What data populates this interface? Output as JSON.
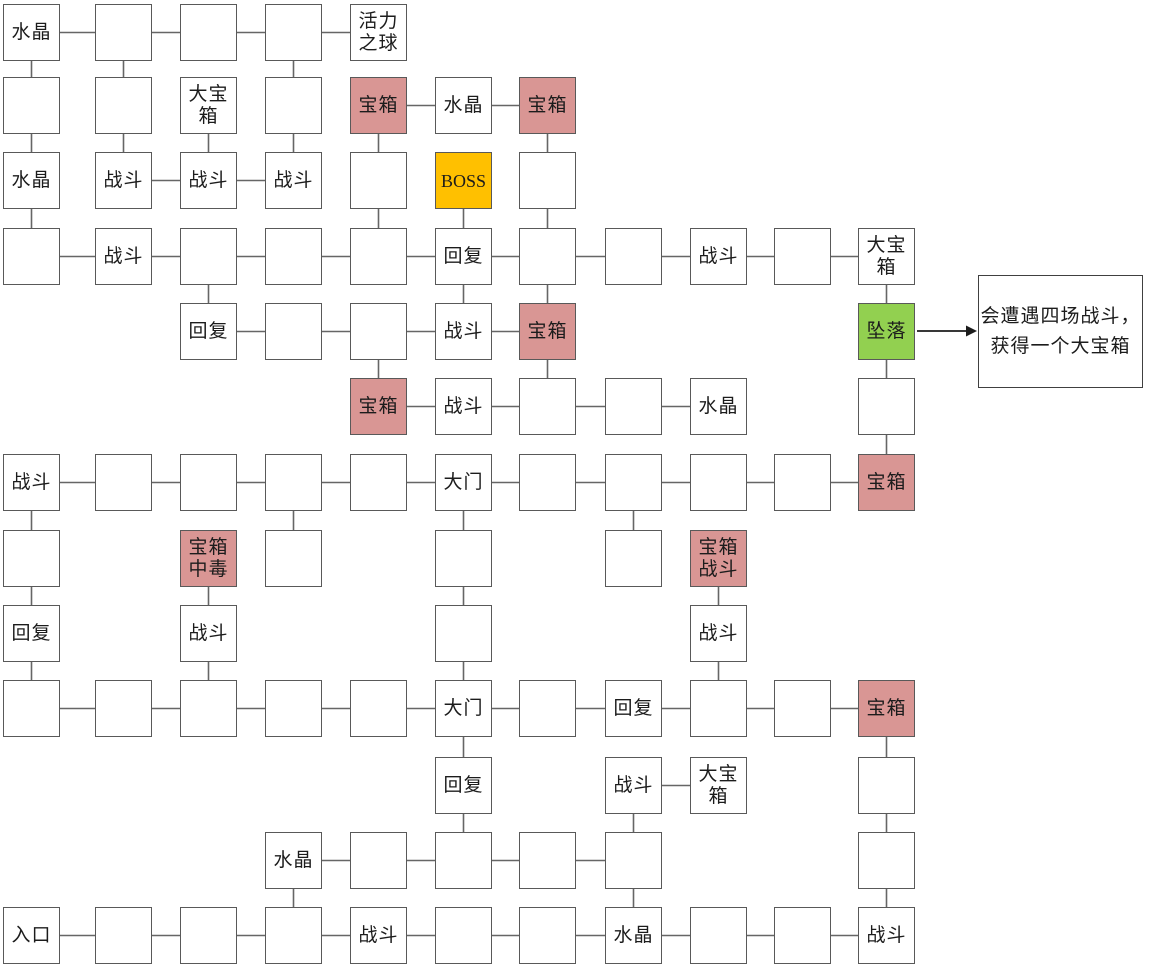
{
  "map": {
    "grid": {
      "col_x": [
        3,
        95,
        180,
        265,
        350,
        435,
        519,
        605,
        690,
        774,
        858
      ],
      "row_y": [
        4,
        77,
        152,
        228,
        303,
        378,
        454,
        530,
        605,
        680,
        757,
        832,
        907
      ],
      "box_w": 57,
      "box_h": 57
    },
    "colors": {
      "room_fill": "#ffffff",
      "chest_fill": "#d99694",
      "boss_fill": "#ffc000",
      "fall_fill": "#92d050",
      "border": "#595959",
      "connector": "#666666",
      "arrow": "#1c1c1c",
      "text": "#1c1c1c"
    },
    "nodes": [
      {
        "id": "r0c0",
        "row": 0,
        "col": 0,
        "type": "normal",
        "label": "水晶"
      },
      {
        "id": "r0c1",
        "row": 0,
        "col": 1,
        "type": "normal",
        "label": ""
      },
      {
        "id": "r0c2",
        "row": 0,
        "col": 2,
        "type": "normal",
        "label": ""
      },
      {
        "id": "r0c3",
        "row": 0,
        "col": 3,
        "type": "normal",
        "label": ""
      },
      {
        "id": "r0c4",
        "row": 0,
        "col": 4,
        "type": "normal",
        "label": "活力\n之球"
      },
      {
        "id": "r1c0",
        "row": 1,
        "col": 0,
        "type": "normal",
        "label": ""
      },
      {
        "id": "r1c1",
        "row": 1,
        "col": 1,
        "type": "normal",
        "label": ""
      },
      {
        "id": "r1c2",
        "row": 1,
        "col": 2,
        "type": "normal",
        "label": "大宝\n箱"
      },
      {
        "id": "r1c3",
        "row": 1,
        "col": 3,
        "type": "normal",
        "label": ""
      },
      {
        "id": "r1c4",
        "row": 1,
        "col": 4,
        "type": "chest",
        "label": "宝箱"
      },
      {
        "id": "r1c5",
        "row": 1,
        "col": 5,
        "type": "normal",
        "label": "水晶"
      },
      {
        "id": "r1c6",
        "row": 1,
        "col": 6,
        "type": "chest",
        "label": "宝箱"
      },
      {
        "id": "r2c0",
        "row": 2,
        "col": 0,
        "type": "normal",
        "label": "水晶"
      },
      {
        "id": "r2c1",
        "row": 2,
        "col": 1,
        "type": "normal",
        "label": "战斗"
      },
      {
        "id": "r2c2",
        "row": 2,
        "col": 2,
        "type": "normal",
        "label": "战斗"
      },
      {
        "id": "r2c3",
        "row": 2,
        "col": 3,
        "type": "normal",
        "label": "战斗"
      },
      {
        "id": "r2c4",
        "row": 2,
        "col": 4,
        "type": "normal",
        "label": ""
      },
      {
        "id": "r2c5",
        "row": 2,
        "col": 5,
        "type": "boss",
        "label": "BOSS"
      },
      {
        "id": "r2c6",
        "row": 2,
        "col": 6,
        "type": "normal",
        "label": ""
      },
      {
        "id": "r3c0",
        "row": 3,
        "col": 0,
        "type": "normal",
        "label": ""
      },
      {
        "id": "r3c1",
        "row": 3,
        "col": 1,
        "type": "normal",
        "label": "战斗"
      },
      {
        "id": "r3c2",
        "row": 3,
        "col": 2,
        "type": "normal",
        "label": ""
      },
      {
        "id": "r3c3",
        "row": 3,
        "col": 3,
        "type": "normal",
        "label": ""
      },
      {
        "id": "r3c4",
        "row": 3,
        "col": 4,
        "type": "normal",
        "label": ""
      },
      {
        "id": "r3c5",
        "row": 3,
        "col": 5,
        "type": "normal",
        "label": "回复"
      },
      {
        "id": "r3c6",
        "row": 3,
        "col": 6,
        "type": "normal",
        "label": ""
      },
      {
        "id": "r3c7",
        "row": 3,
        "col": 7,
        "type": "normal",
        "label": ""
      },
      {
        "id": "r3c8",
        "row": 3,
        "col": 8,
        "type": "normal",
        "label": "战斗"
      },
      {
        "id": "r3c9",
        "row": 3,
        "col": 9,
        "type": "normal",
        "label": ""
      },
      {
        "id": "r3c10",
        "row": 3,
        "col": 10,
        "type": "normal",
        "label": "大宝\n箱"
      },
      {
        "id": "r4c2",
        "row": 4,
        "col": 2,
        "type": "normal",
        "label": "回复"
      },
      {
        "id": "r4c3",
        "row": 4,
        "col": 3,
        "type": "normal",
        "label": ""
      },
      {
        "id": "r4c4",
        "row": 4,
        "col": 4,
        "type": "normal",
        "label": ""
      },
      {
        "id": "r4c5",
        "row": 4,
        "col": 5,
        "type": "normal",
        "label": "战斗"
      },
      {
        "id": "r4c6",
        "row": 4,
        "col": 6,
        "type": "chest",
        "label": "宝箱"
      },
      {
        "id": "r4c10",
        "row": 4,
        "col": 10,
        "type": "fall",
        "label": "坠落"
      },
      {
        "id": "r5c4",
        "row": 5,
        "col": 4,
        "type": "chest",
        "label": "宝箱"
      },
      {
        "id": "r5c5",
        "row": 5,
        "col": 5,
        "type": "normal",
        "label": "战斗"
      },
      {
        "id": "r5c6",
        "row": 5,
        "col": 6,
        "type": "normal",
        "label": ""
      },
      {
        "id": "r5c7",
        "row": 5,
        "col": 7,
        "type": "normal",
        "label": ""
      },
      {
        "id": "r5c8",
        "row": 5,
        "col": 8,
        "type": "normal",
        "label": "水晶"
      },
      {
        "id": "r5c10",
        "row": 5,
        "col": 10,
        "type": "normal",
        "label": ""
      },
      {
        "id": "r6c0",
        "row": 6,
        "col": 0,
        "type": "normal",
        "label": "战斗"
      },
      {
        "id": "r6c1",
        "row": 6,
        "col": 1,
        "type": "normal",
        "label": ""
      },
      {
        "id": "r6c2",
        "row": 6,
        "col": 2,
        "type": "normal",
        "label": ""
      },
      {
        "id": "r6c3",
        "row": 6,
        "col": 3,
        "type": "normal",
        "label": ""
      },
      {
        "id": "r6c4",
        "row": 6,
        "col": 4,
        "type": "normal",
        "label": ""
      },
      {
        "id": "r6c5",
        "row": 6,
        "col": 5,
        "type": "normal",
        "label": "大门"
      },
      {
        "id": "r6c6",
        "row": 6,
        "col": 6,
        "type": "normal",
        "label": ""
      },
      {
        "id": "r6c7",
        "row": 6,
        "col": 7,
        "type": "normal",
        "label": ""
      },
      {
        "id": "r6c8",
        "row": 6,
        "col": 8,
        "type": "normal",
        "label": ""
      },
      {
        "id": "r6c9",
        "row": 6,
        "col": 9,
        "type": "normal",
        "label": ""
      },
      {
        "id": "r6c10",
        "row": 6,
        "col": 10,
        "type": "chest",
        "label": "宝箱"
      },
      {
        "id": "r7c0",
        "row": 7,
        "col": 0,
        "type": "normal",
        "label": ""
      },
      {
        "id": "r7c2",
        "row": 7,
        "col": 2,
        "type": "chest",
        "label": "宝箱\n中毒"
      },
      {
        "id": "r7c3",
        "row": 7,
        "col": 3,
        "type": "normal",
        "label": ""
      },
      {
        "id": "r7c5",
        "row": 7,
        "col": 5,
        "type": "normal",
        "label": ""
      },
      {
        "id": "r7c7",
        "row": 7,
        "col": 7,
        "type": "normal",
        "label": ""
      },
      {
        "id": "r7c8",
        "row": 7,
        "col": 8,
        "type": "chest",
        "label": "宝箱\n战斗"
      },
      {
        "id": "r8c0",
        "row": 8,
        "col": 0,
        "type": "normal",
        "label": "回复"
      },
      {
        "id": "r8c2",
        "row": 8,
        "col": 2,
        "type": "normal",
        "label": "战斗"
      },
      {
        "id": "r8c5",
        "row": 8,
        "col": 5,
        "type": "normal",
        "label": ""
      },
      {
        "id": "r8c8",
        "row": 8,
        "col": 8,
        "type": "normal",
        "label": "战斗"
      },
      {
        "id": "r9c0",
        "row": 9,
        "col": 0,
        "type": "normal",
        "label": ""
      },
      {
        "id": "r9c1",
        "row": 9,
        "col": 1,
        "type": "normal",
        "label": ""
      },
      {
        "id": "r9c2",
        "row": 9,
        "col": 2,
        "type": "normal",
        "label": ""
      },
      {
        "id": "r9c3",
        "row": 9,
        "col": 3,
        "type": "normal",
        "label": ""
      },
      {
        "id": "r9c4",
        "row": 9,
        "col": 4,
        "type": "normal",
        "label": ""
      },
      {
        "id": "r9c5",
        "row": 9,
        "col": 5,
        "type": "normal",
        "label": "大门"
      },
      {
        "id": "r9c6",
        "row": 9,
        "col": 6,
        "type": "normal",
        "label": ""
      },
      {
        "id": "r9c7",
        "row": 9,
        "col": 7,
        "type": "normal",
        "label": "回复"
      },
      {
        "id": "r9c8",
        "row": 9,
        "col": 8,
        "type": "normal",
        "label": ""
      },
      {
        "id": "r9c9",
        "row": 9,
        "col": 9,
        "type": "normal",
        "label": ""
      },
      {
        "id": "r9c10",
        "row": 9,
        "col": 10,
        "type": "chest",
        "label": "宝箱"
      },
      {
        "id": "r10c5",
        "row": 10,
        "col": 5,
        "type": "normal",
        "label": "回复"
      },
      {
        "id": "r10c7",
        "row": 10,
        "col": 7,
        "type": "normal",
        "label": "战斗"
      },
      {
        "id": "r10c8",
        "row": 10,
        "col": 8,
        "type": "normal",
        "label": "大宝\n箱"
      },
      {
        "id": "r10c10",
        "row": 10,
        "col": 10,
        "type": "normal",
        "label": ""
      },
      {
        "id": "r11c3",
        "row": 11,
        "col": 3,
        "type": "normal",
        "label": "水晶"
      },
      {
        "id": "r11c4",
        "row": 11,
        "col": 4,
        "type": "normal",
        "label": ""
      },
      {
        "id": "r11c5",
        "row": 11,
        "col": 5,
        "type": "normal",
        "label": ""
      },
      {
        "id": "r11c6",
        "row": 11,
        "col": 6,
        "type": "normal",
        "label": ""
      },
      {
        "id": "r11c7",
        "row": 11,
        "col": 7,
        "type": "normal",
        "label": ""
      },
      {
        "id": "r11c10",
        "row": 11,
        "col": 10,
        "type": "normal",
        "label": ""
      },
      {
        "id": "r12c0",
        "row": 12,
        "col": 0,
        "type": "normal",
        "label": "入口"
      },
      {
        "id": "r12c1",
        "row": 12,
        "col": 1,
        "type": "normal",
        "label": ""
      },
      {
        "id": "r12c2",
        "row": 12,
        "col": 2,
        "type": "normal",
        "label": ""
      },
      {
        "id": "r12c3",
        "row": 12,
        "col": 3,
        "type": "normal",
        "label": ""
      },
      {
        "id": "r12c4",
        "row": 12,
        "col": 4,
        "type": "normal",
        "label": "战斗"
      },
      {
        "id": "r12c5",
        "row": 12,
        "col": 5,
        "type": "normal",
        "label": ""
      },
      {
        "id": "r12c6",
        "row": 12,
        "col": 6,
        "type": "normal",
        "label": ""
      },
      {
        "id": "r12c7",
        "row": 12,
        "col": 7,
        "type": "normal",
        "label": "水晶"
      },
      {
        "id": "r12c8",
        "row": 12,
        "col": 8,
        "type": "normal",
        "label": ""
      },
      {
        "id": "r12c9",
        "row": 12,
        "col": 9,
        "type": "normal",
        "label": ""
      },
      {
        "id": "r12c10",
        "row": 12,
        "col": 10,
        "type": "normal",
        "label": "战斗"
      }
    ],
    "edges": [
      [
        "r0c0",
        "r0c1"
      ],
      [
        "r0c1",
        "r0c2"
      ],
      [
        "r0c2",
        "r0c3"
      ],
      [
        "r0c3",
        "r0c4"
      ],
      [
        "r1c4",
        "r1c5"
      ],
      [
        "r1c5",
        "r1c6"
      ],
      [
        "r2c1",
        "r2c2"
      ],
      [
        "r2c2",
        "r2c3"
      ],
      [
        "r3c0",
        "r3c1"
      ],
      [
        "r3c1",
        "r3c2"
      ],
      [
        "r3c2",
        "r3c3"
      ],
      [
        "r3c3",
        "r3c4"
      ],
      [
        "r3c4",
        "r3c5"
      ],
      [
        "r3c5",
        "r3c6"
      ],
      [
        "r3c6",
        "r3c7"
      ],
      [
        "r3c7",
        "r3c8"
      ],
      [
        "r3c8",
        "r3c9"
      ],
      [
        "r3c9",
        "r3c10"
      ],
      [
        "r4c2",
        "r4c3"
      ],
      [
        "r4c3",
        "r4c4"
      ],
      [
        "r4c4",
        "r4c5"
      ],
      [
        "r4c5",
        "r4c6"
      ],
      [
        "r5c4",
        "r5c5"
      ],
      [
        "r5c5",
        "r5c6"
      ],
      [
        "r5c6",
        "r5c7"
      ],
      [
        "r5c7",
        "r5c8"
      ],
      [
        "r6c0",
        "r6c1"
      ],
      [
        "r6c1",
        "r6c2"
      ],
      [
        "r6c2",
        "r6c3"
      ],
      [
        "r6c3",
        "r6c4"
      ],
      [
        "r6c4",
        "r6c5"
      ],
      [
        "r6c5",
        "r6c6"
      ],
      [
        "r6c6",
        "r6c7"
      ],
      [
        "r6c7",
        "r6c8"
      ],
      [
        "r6c8",
        "r6c9"
      ],
      [
        "r6c9",
        "r6c10"
      ],
      [
        "r9c0",
        "r9c1"
      ],
      [
        "r9c1",
        "r9c2"
      ],
      [
        "r9c2",
        "r9c3"
      ],
      [
        "r9c3",
        "r9c4"
      ],
      [
        "r9c4",
        "r9c5"
      ],
      [
        "r9c5",
        "r9c6"
      ],
      [
        "r9c6",
        "r9c7"
      ],
      [
        "r9c7",
        "r9c8"
      ],
      [
        "r9c8",
        "r9c9"
      ],
      [
        "r9c9",
        "r9c10"
      ],
      [
        "r10c7",
        "r10c8"
      ],
      [
        "r11c3",
        "r11c4"
      ],
      [
        "r11c4",
        "r11c5"
      ],
      [
        "r11c5",
        "r11c6"
      ],
      [
        "r11c6",
        "r11c7"
      ],
      [
        "r12c0",
        "r12c1"
      ],
      [
        "r12c1",
        "r12c2"
      ],
      [
        "r12c2",
        "r12c3"
      ],
      [
        "r12c3",
        "r12c4"
      ],
      [
        "r12c4",
        "r12c5"
      ],
      [
        "r12c5",
        "r12c6"
      ],
      [
        "r12c6",
        "r12c7"
      ],
      [
        "r12c7",
        "r12c8"
      ],
      [
        "r12c8",
        "r12c9"
      ],
      [
        "r12c9",
        "r12c10"
      ],
      [
        "r0c0",
        "r1c0"
      ],
      [
        "r1c0",
        "r2c0"
      ],
      [
        "r2c0",
        "r3c0"
      ],
      [
        "r6c0",
        "r7c0"
      ],
      [
        "r7c0",
        "r8c0"
      ],
      [
        "r8c0",
        "r9c0"
      ],
      [
        "r0c1",
        "r1c1"
      ],
      [
        "r1c1",
        "r2c1"
      ],
      [
        "r1c2",
        "r2c2"
      ],
      [
        "r3c2",
        "r4c2"
      ],
      [
        "r7c2",
        "r8c2"
      ],
      [
        "r8c2",
        "r9c2"
      ],
      [
        "r0c3",
        "r1c3"
      ],
      [
        "r1c3",
        "r2c3"
      ],
      [
        "r6c3",
        "r7c3"
      ],
      [
        "r11c3",
        "r12c3"
      ],
      [
        "r1c4",
        "r2c4"
      ],
      [
        "r2c4",
        "r3c4"
      ],
      [
        "r4c4",
        "r5c4"
      ],
      [
        "r2c5",
        "r3c5"
      ],
      [
        "r3c5",
        "r4c5"
      ],
      [
        "r6c5",
        "r7c5"
      ],
      [
        "r7c5",
        "r8c5"
      ],
      [
        "r8c5",
        "r9c5"
      ],
      [
        "r9c5",
        "r10c5"
      ],
      [
        "r10c5",
        "r11c5"
      ],
      [
        "r1c6",
        "r2c6"
      ],
      [
        "r2c6",
        "r3c6"
      ],
      [
        "r3c6",
        "r4c6"
      ],
      [
        "r4c6",
        "r5c6"
      ],
      [
        "r6c7",
        "r7c7"
      ],
      [
        "r10c7",
        "r11c7"
      ],
      [
        "r11c7",
        "r12c7"
      ],
      [
        "r7c8",
        "r8c8"
      ],
      [
        "r8c8",
        "r9c8"
      ],
      [
        "r3c10",
        "r4c10"
      ],
      [
        "r4c10",
        "r5c10"
      ],
      [
        "r5c10",
        "r6c10"
      ],
      [
        "r9c10",
        "r10c10"
      ],
      [
        "r10c10",
        "r11c10"
      ],
      [
        "r11c10",
        "r12c10"
      ]
    ],
    "annotation": {
      "x": 978,
      "y": 275,
      "w": 165,
      "h": 113,
      "lines": [
        "会遭遇四场战斗，",
        "获得一个大宝箱"
      ]
    },
    "arrow": {
      "x1": 917,
      "y1": 331,
      "x2": 977,
      "y2": 331
    }
  }
}
